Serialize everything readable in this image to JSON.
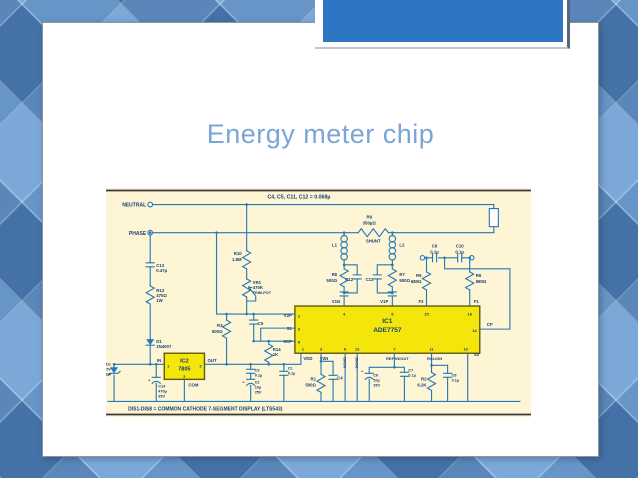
{
  "slide": {
    "title": "Energy meter chip"
  },
  "circuit": {
    "header_note": "C4, C5, C11, C12 = 0.068µ",
    "footer_note": "DIS1-DIS8 = COMMON CATHODE 7-SEGMENT DISPLAY (LTS543)",
    "terminals": {
      "neutral": "NEUTRAL",
      "phase": "PHASE"
    },
    "ic1": {
      "ref": "IC1",
      "part": "ADE7757",
      "pins": {
        "p1": "1",
        "p2": "2",
        "p3": "3",
        "p4": "4",
        "p5": "5",
        "p6": "6",
        "p7": "7",
        "p8": "8",
        "p9": "9",
        "p10": "10",
        "p11": "11",
        "p13": "13",
        "p14": "14",
        "p15": "15",
        "p16": "16"
      },
      "pin_labels": {
        "v2p": "V2P",
        "s1": "S1",
        "scf": "SCF",
        "v1n": "V1N",
        "v1p": "V1P",
        "f2": "F2",
        "f1": "F1",
        "cf": "CF",
        "vdd": "VDD",
        "v2n": "V2N",
        "agnd": "AGND",
        "dgnd": "DGND",
        "ref": "REF IN/OUT",
        "rclkin": "RCLKIN",
        "s0": "S0"
      }
    },
    "ic2": {
      "ref": "IC2",
      "part": "7805",
      "pin_in": "IN",
      "pin_out": "OUT",
      "pin_com": "COM",
      "n1": "1",
      "n2": "2",
      "n3": "3"
    },
    "labels": {
      "r9_ref": "R9",
      "r9_val": "350µΩ",
      "r9_type": "SHUNT",
      "r10_ref": "R10",
      "r10_val": "1.8M",
      "vr1_ref": "VR1",
      "vr1_val": "470K",
      "vr1_type": "TRIM-POT",
      "c13_ref": "C13",
      "c13_val": "0.47µ",
      "r13_ref": "R13",
      "r13_val": "470Ω",
      "r13_pow": "1W",
      "d1_ref": "D1",
      "d1_val": "1N4007",
      "zd1_ref": "ZD1",
      "zd1_val": "5V",
      "zd1_pow": "1W",
      "c14_ref": "C14",
      "c14_val": "470µ",
      "c14_volt": "35V",
      "l1_ref": "L1",
      "l2_ref": "L2",
      "r8_ref": "R8",
      "r8_val": "500Ω",
      "r7_ref": "R7",
      "r7_val": "500Ω",
      "c12_ref": "C12",
      "c11_ref": "C11",
      "c9_ref": "C9",
      "c9_val": "0.1µ",
      "c10_ref": "C10",
      "c10_val": "0.1µ",
      "r5_ref": "R5",
      "r5_val": "680Ω",
      "r6_ref": "R6",
      "r6_val": "680Ω",
      "r3_ref": "R3",
      "r3_val": "500Ω",
      "c5_ref": "C5",
      "r14_ref": "R14",
      "r14_val": "1K",
      "c3_ref": "C3",
      "c3_val": "0.1µ",
      "c2_ref": "C2",
      "c2_val": "10µ",
      "c2_volt": "25V",
      "c1_ref": "C1",
      "c1_val": "0.1µ",
      "r1_ref": "R1",
      "r1_val": "500Ω",
      "c4_ref": "C4",
      "c6_ref": "C6",
      "c6_val": "10µ",
      "c6_volt": "25V",
      "c7_ref": "C7",
      "c7_val": "0.1µ",
      "r2_ref": "R2",
      "r2_val": "6.2K",
      "c8_ref": "C8",
      "c8_val": "0.1µ",
      "plus": "+"
    }
  }
}
